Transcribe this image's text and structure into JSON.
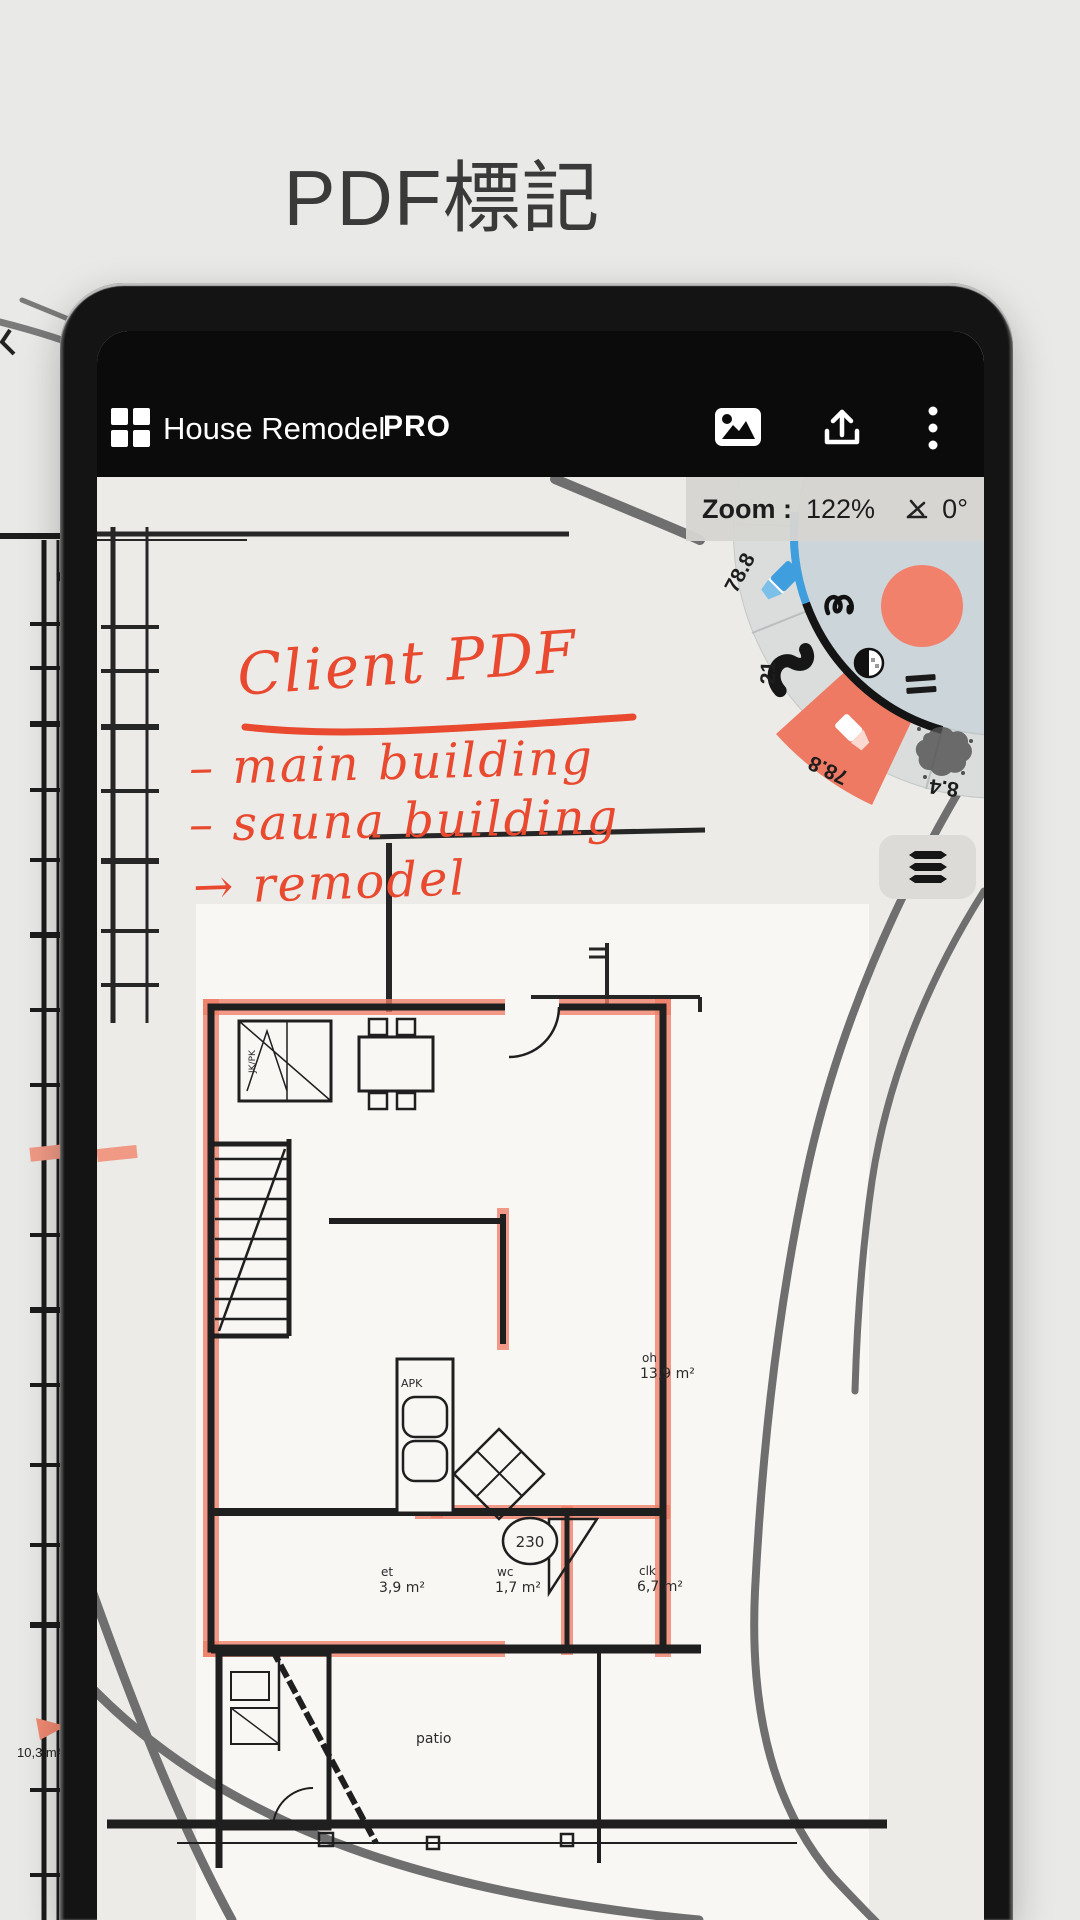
{
  "title": "PDF標記",
  "app_bar": {
    "title": "House Remodel",
    "badge": "PRO",
    "icons": [
      "grid-icon",
      "image-icon",
      "share-icon",
      "overflow-menu-icon"
    ]
  },
  "zoom_bar": {
    "label": "Zoom :",
    "value": "122%",
    "angle_icon": "angle-disabled-icon",
    "angle": "0°"
  },
  "tool_wheel": {
    "segments": {
      "highlighter": "78.8",
      "brush": "21",
      "marker": "78.8",
      "airbrush": "8.4"
    },
    "active_segment": "marker",
    "center_icons": [
      "stroke-preview-icon",
      "color-swatch",
      "opacity-icon",
      "line-spacing-icon"
    ],
    "colors": {
      "active": "#ee7a64",
      "swatch": "#f2816c",
      "accent_blue": "#3f9ede",
      "ring": "#dadddc",
      "disc": "#ccd5d9"
    }
  },
  "layers_button_icon": "layers-icon",
  "annotations": {
    "ink_color": "#e8492f",
    "heading": "Client PDF",
    "items": [
      "– main building",
      "– sauna building",
      "→ remodel"
    ]
  },
  "floor_plan": {
    "rooms": [
      {
        "name": "oh",
        "area": "13,9 m²"
      },
      {
        "name": "et",
        "area": "3,9 m²"
      },
      {
        "name": "wc",
        "area": "1,7 m²"
      },
      {
        "name": "clk",
        "area": "6,7 m²"
      }
    ],
    "labels": {
      "fixture": "APK",
      "door_width": "230",
      "outdoor": "patio",
      "closet": "JK/PK"
    }
  },
  "background": {
    "area_label": "10,3 m²"
  }
}
